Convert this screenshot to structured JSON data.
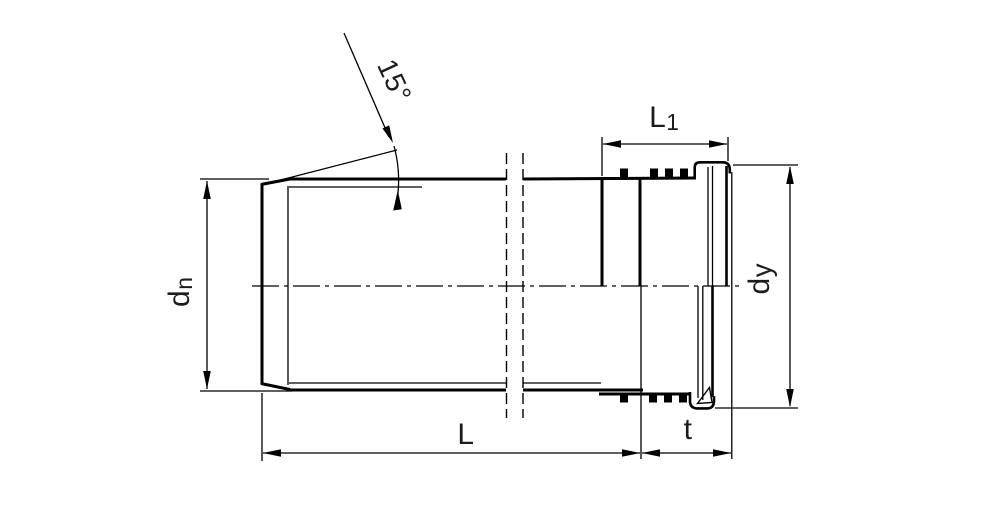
{
  "diagram": {
    "subject": "Socketed pipe longitudinal section with dimension annotations",
    "background": "#ffffff",
    "line_color": "#000000",
    "text_color": "#1c1c1c",
    "dimensions": {
      "chamfer_angle": "15°",
      "l1": {
        "main": "L",
        "sub": "1"
      },
      "dn": {
        "main": "d",
        "sub": "n"
      },
      "dy": {
        "main": "d",
        "sub": "y"
      },
      "length": "L",
      "socket_depth": "t"
    }
  }
}
